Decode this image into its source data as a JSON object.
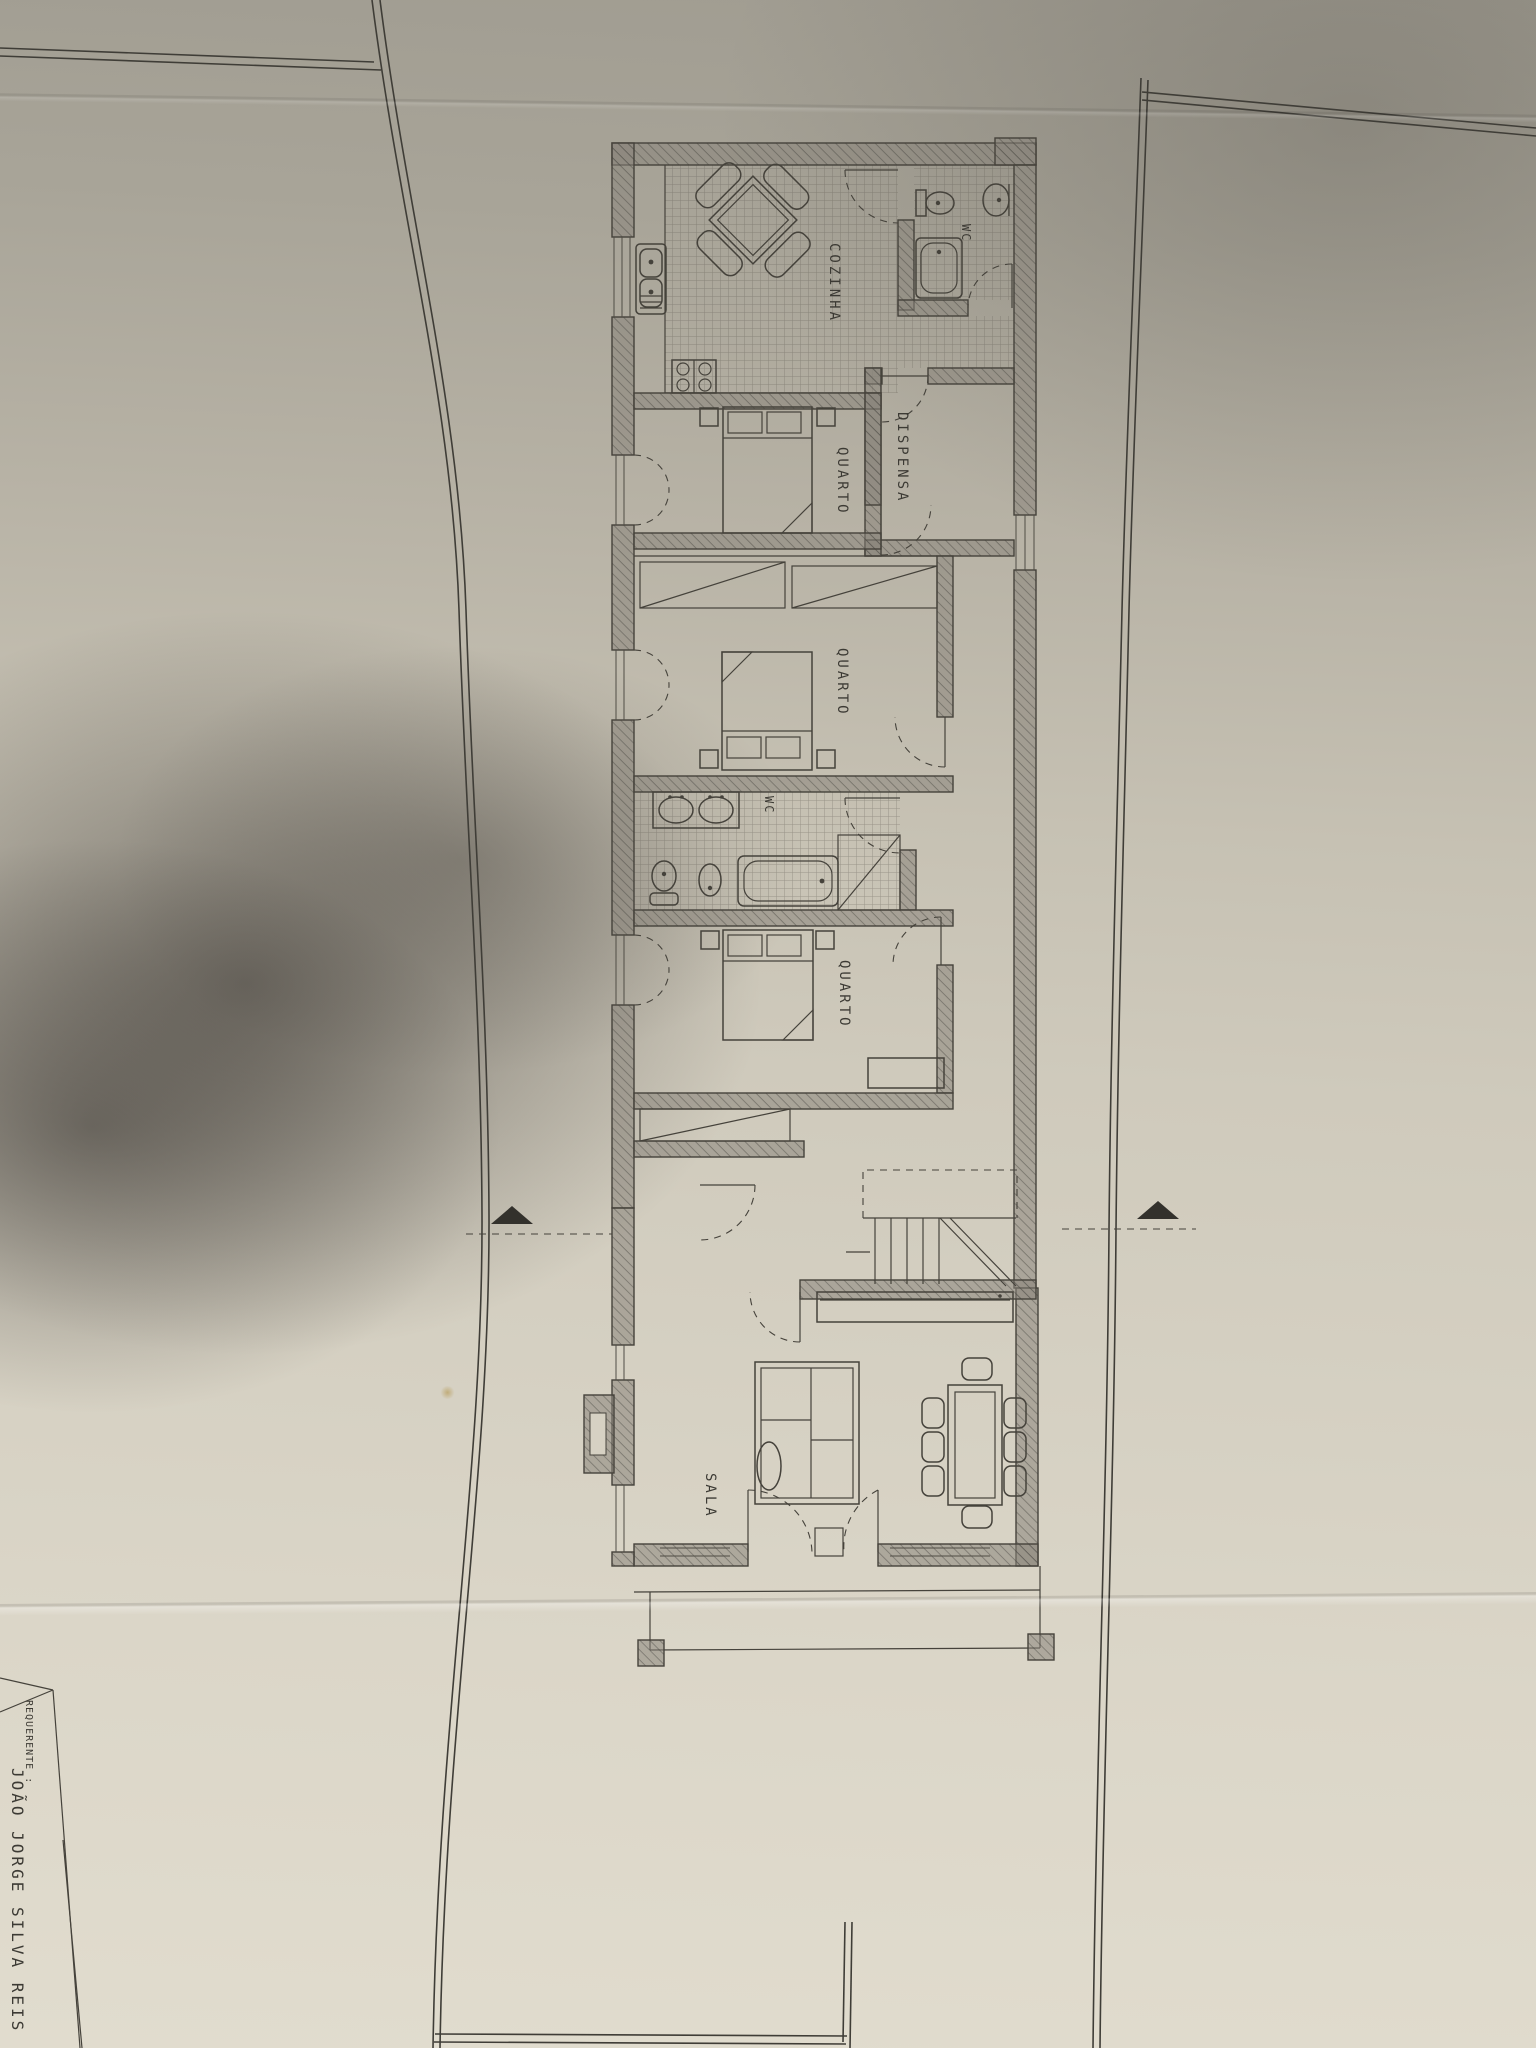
{
  "labels": {
    "cozinha": "COZINHA",
    "wc_top": "WC",
    "dispensa": "DISPENSA",
    "quarto1": "QUARTO",
    "quarto2": "QUARTO",
    "wc_middle": "WC",
    "quarto3": "QUARTO",
    "sala": "SALA"
  },
  "title_block": {
    "field_label": "REQUERENTE :",
    "applicant_name": "JOÃO JORGE SILVA REIS"
  },
  "colors": {
    "paper_light": "#e1dcce",
    "paper_dark": "#a09c91",
    "ink": "#45423b",
    "shadow": "#221e1b",
    "stain": "#b08f3e"
  }
}
